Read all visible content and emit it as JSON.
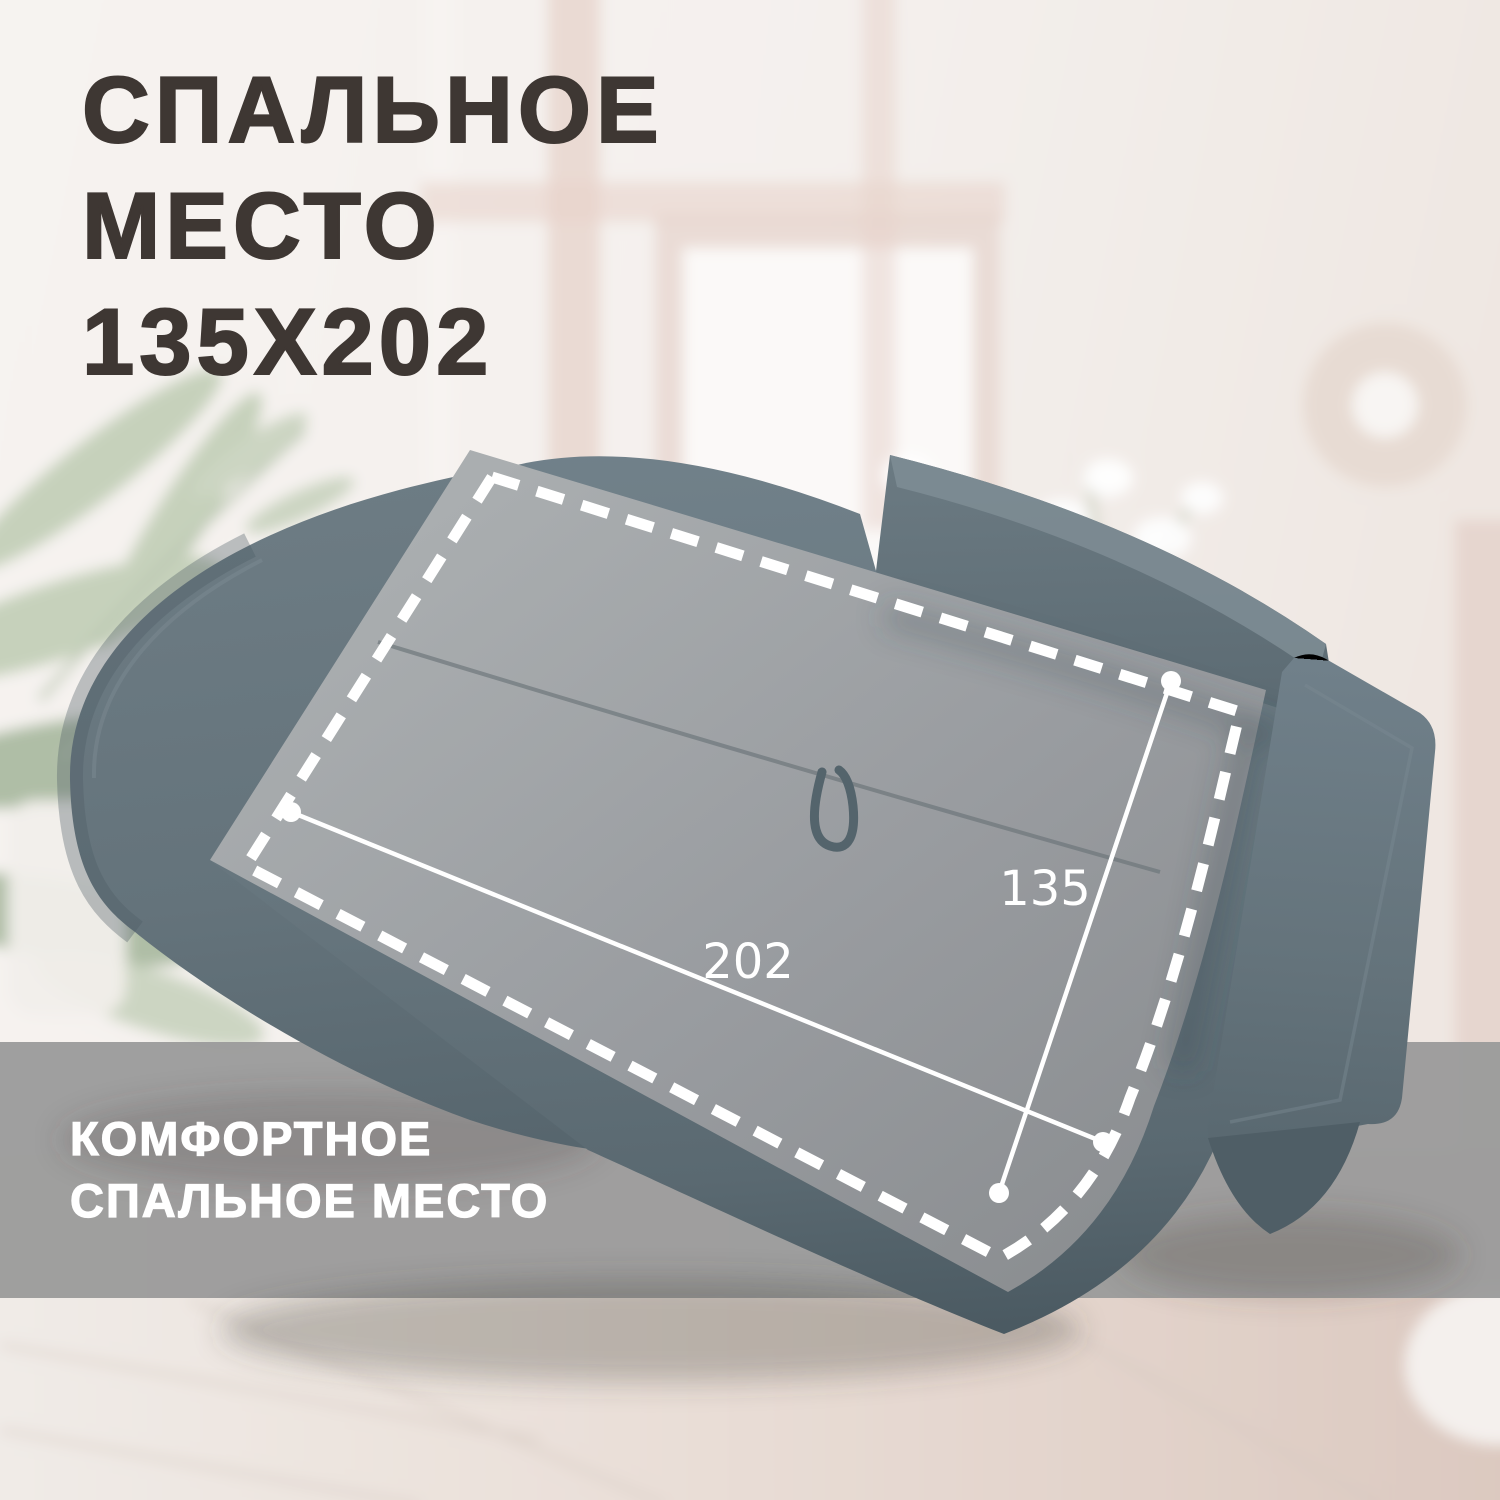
{
  "canvas": {
    "width": 1500,
    "height": 1500
  },
  "title": {
    "line1": "СПАЛЬНОЕ",
    "line2": "МЕСТО",
    "line3": "135X202",
    "color": "#3E3733"
  },
  "banner": {
    "line1": "КОМФОРТНОЕ",
    "line2": "СПАЛЬНОЕ МЕСТО",
    "background": "#9B9B9B",
    "text_color": "#FFFFFF"
  },
  "dimensions": {
    "length_label": "202",
    "width_label": "135",
    "line_color": "#FFFFFF"
  },
  "sofa": {
    "fabric_light": "#75848C",
    "fabric_base": "#68777F",
    "fabric_dark": "#55646C",
    "fabric_darker": "#4B5A62",
    "highlight_light": "#AAAEB0",
    "highlight_dark": "#8B8E91"
  },
  "scene": {
    "wall": "#F4F0ED",
    "wall_warm": "#EFE7E2",
    "frame_pink": "#E5D0C8",
    "door_white": "#FBF9F8",
    "ring_decor": "#E7DBD3",
    "plant_green": "#C2CDB6",
    "plant_green_dark": "#A9B8A0",
    "floor_light": "#F0EBE7",
    "floor_warm": "#DCC9C0"
  }
}
